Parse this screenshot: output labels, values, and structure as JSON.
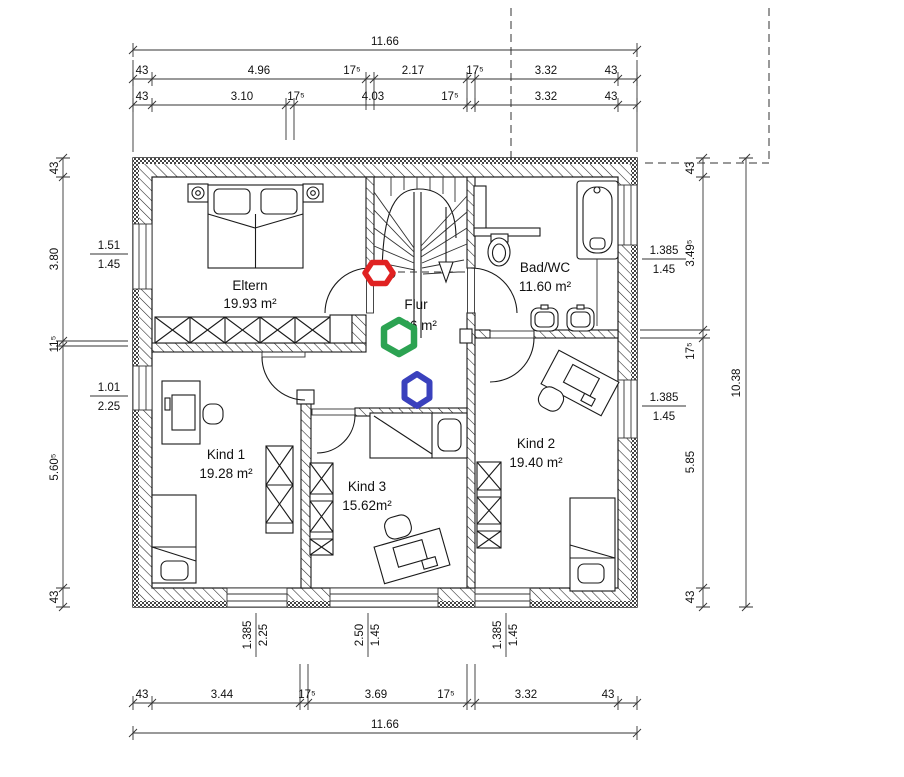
{
  "drawing": {
    "type": "architectural-floor-plan",
    "floor": "Obergeschoss"
  },
  "rooms": {
    "eltern": {
      "name": "Eltern",
      "area": "19.93 m²"
    },
    "flur": {
      "name": "Flur",
      "area": "9.36 m²"
    },
    "bad": {
      "name": "Bad/WC",
      "area": "11.60 m²"
    },
    "kind1": {
      "name": "Kind 1",
      "area": "19.28 m²"
    },
    "kind2": {
      "name": "Kind 2",
      "area": "19.40 m²"
    },
    "kind3": {
      "name": "Kind 3",
      "area": "15.62m²"
    }
  },
  "dims": {
    "top": {
      "overall": "11.66",
      "row1": [
        "43",
        "4.96",
        "17⁵",
        "2.17",
        "17⁵",
        "3.32",
        "43"
      ],
      "row2": [
        "43",
        "3.10",
        "17⁵",
        "4.03",
        "17⁵",
        "3.32",
        "43"
      ]
    },
    "bottom": {
      "overall": "11.66",
      "row": [
        "43",
        "3.44",
        "17⁵",
        "3.69",
        "17⁵",
        "3.32",
        "43"
      ],
      "windows": [
        {
          "w": "1.385",
          "h": "2.25"
        },
        {
          "w": "2.50",
          "h": "1.45"
        },
        {
          "w": "1.385",
          "h": "1.45"
        }
      ]
    },
    "left": {
      "col": [
        "43",
        "3.80",
        "11⁵",
        "5.60⁵",
        "43"
      ],
      "windows": [
        {
          "w": "1.51",
          "h": "1.45"
        },
        {
          "w": "1.01",
          "h": "2.25"
        }
      ]
    },
    "right": {
      "overall": "10.38",
      "col": [
        "43",
        "3.49⁵",
        "17⁵",
        "5.85",
        "43"
      ],
      "windows": [
        {
          "w": "1.385",
          "h": "1.45"
        },
        {
          "w": "1.385",
          "h": "1.45"
        }
      ]
    }
  },
  "markers": {
    "red": {
      "color": "#e02222",
      "transform": "translate(379,273)"
    },
    "green": {
      "color": "#2ca352",
      "transform": "translate(399,337)"
    },
    "blue": {
      "color": "#3a41bd",
      "transform": "translate(417,390)"
    }
  }
}
